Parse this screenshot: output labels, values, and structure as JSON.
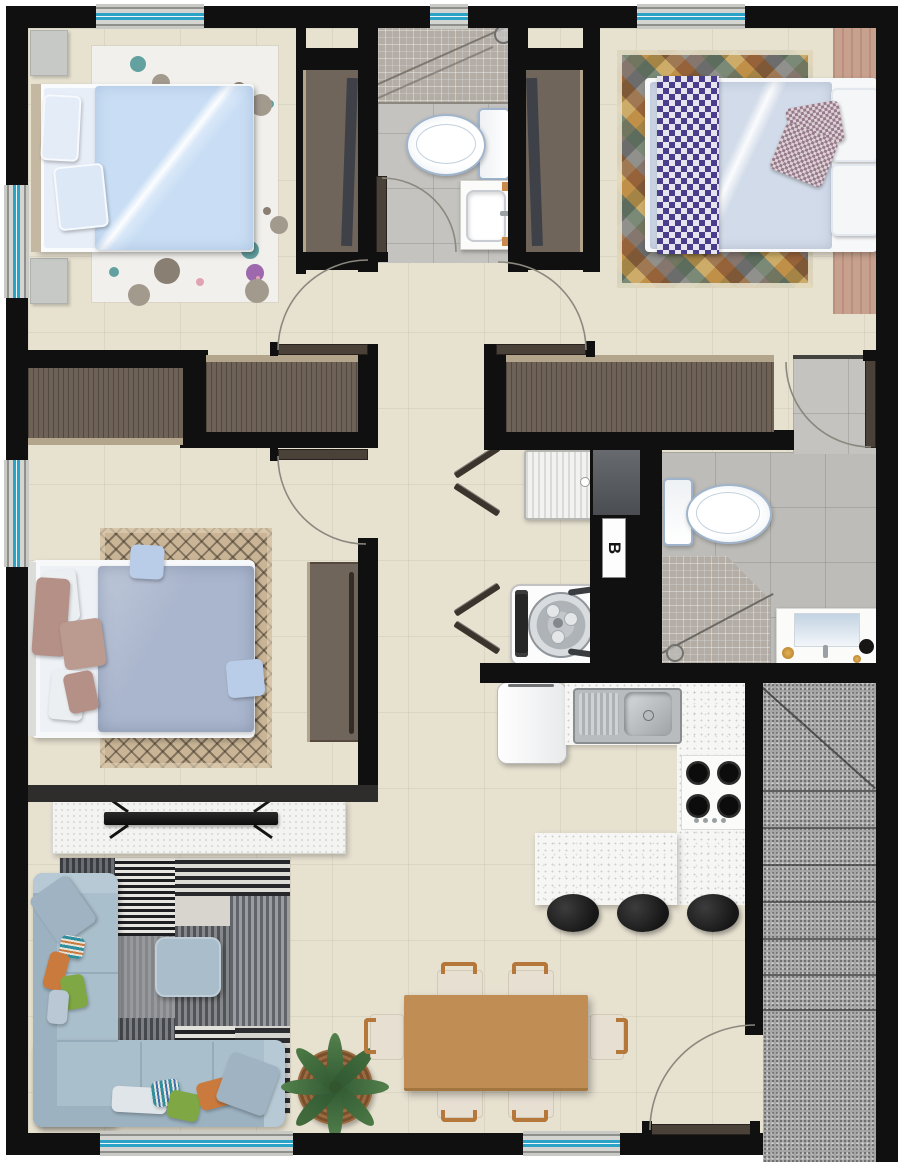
{
  "labels": {
    "utility_shaft": "B"
  },
  "palette": {
    "wall": "#101010",
    "floor_beige": "#e7e1d0",
    "bath_tile_gray": "#c4c3bf",
    "shower_mosaic": "#b3ada5",
    "window_frame_gray": "#c9cac5",
    "window_glass_teal": "#2ba3c6",
    "closet_wood_brown": "#6e6156",
    "trim_wood_tan": "#b3a48c",
    "door_leaf_brown": "#4a4239",
    "bed1_duvet_blue": "#c9def4",
    "bed2_duvet_gray_blue": "#aab6cd",
    "bed3_duvet_blue_gray": "#d2dbe9",
    "bed3_runner_purple": "#4a3d8c",
    "headboard_wood_pink": "#c7a18e",
    "sofa_blue_gray": "#aabfcc",
    "pillow_orange": "#cb7a3d",
    "pillow_green": "#7fa844",
    "dining_table_wood": "#c08d55",
    "chair_wood": "#b5773a",
    "kitchen_counter_white": "#f6f6f4",
    "stool_black": "#1f1f1f",
    "stairs_granite_gray": "#a6a6a6"
  }
}
